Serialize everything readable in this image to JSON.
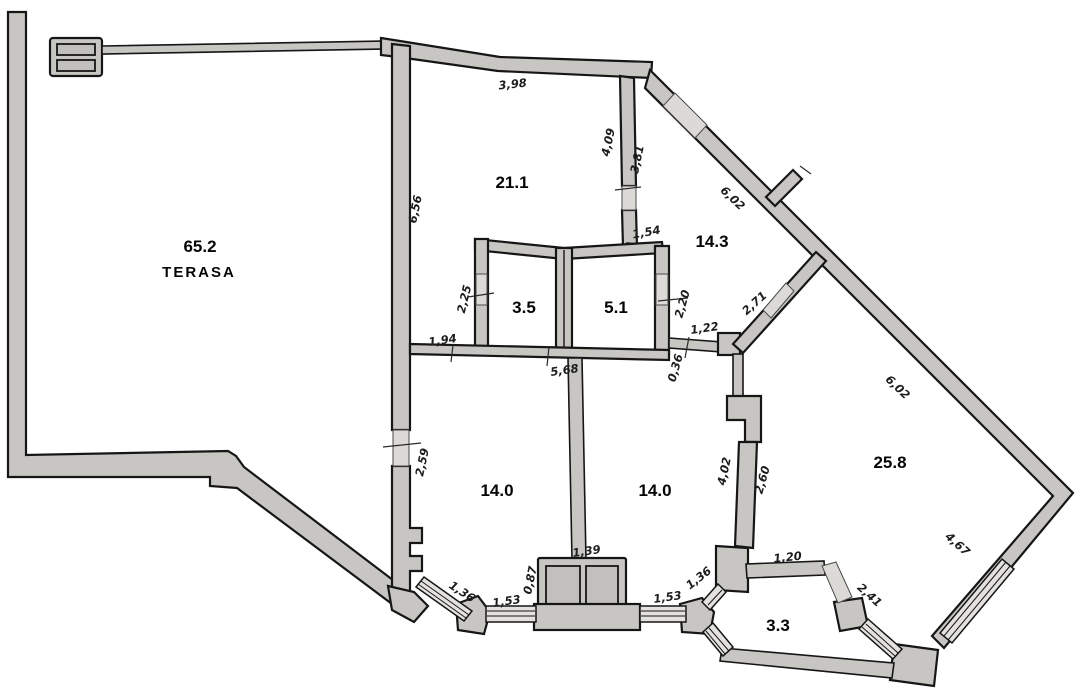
{
  "plan": {
    "type": "apartment-floor-plan",
    "colors": {
      "background": "#ffffff",
      "wall_fill": "#c8c6c2",
      "wall_stroke": "#161616",
      "door_fill": "#dcdad6",
      "window_fill": "#e4e2de",
      "label_color": "#050505",
      "dim_color": "#1d1d1d"
    },
    "rooms": {
      "terasa": {
        "area": "65.2",
        "name": "TERASA"
      },
      "room_21_1": {
        "area": "21.1"
      },
      "hall_14_3": {
        "area": "14.3"
      },
      "room_3_5": {
        "area": "3.5"
      },
      "room_5_1": {
        "area": "5.1"
      },
      "room_14_0_left": {
        "area": "14.0"
      },
      "room_14_0_right": {
        "area": "14.0"
      },
      "room_25_8": {
        "area": "25.8"
      },
      "balcony_3_3": {
        "area": "3.3"
      }
    },
    "dims": {
      "top_wall": "3,98",
      "left_wall_21": "6,56",
      "divider_left": "4,09",
      "divider_right": "3,81",
      "diag_top": "6,02",
      "hall_top": "1,54",
      "wc_left": "2,25",
      "bath_right": "2,20",
      "diag_hall": "2,71",
      "wall_1_94": "1,94",
      "wall_1_22": "1,22",
      "wall_0_36": "0,36",
      "wall_5_68": "5,68",
      "diag_right": "6,02",
      "left_door": "2,59",
      "right_room_wall": "4,02",
      "wall_2_60": "2,60",
      "chimney_top": "1,39",
      "chimney_left": "0,87",
      "window_left": "1,53",
      "window_diag_left": "1,36",
      "window_right": "1,53",
      "window_diag_right": "1,36",
      "balcony_top": "1,20",
      "balcony_door": "2,41",
      "wall_4_67": "4,67"
    }
  }
}
